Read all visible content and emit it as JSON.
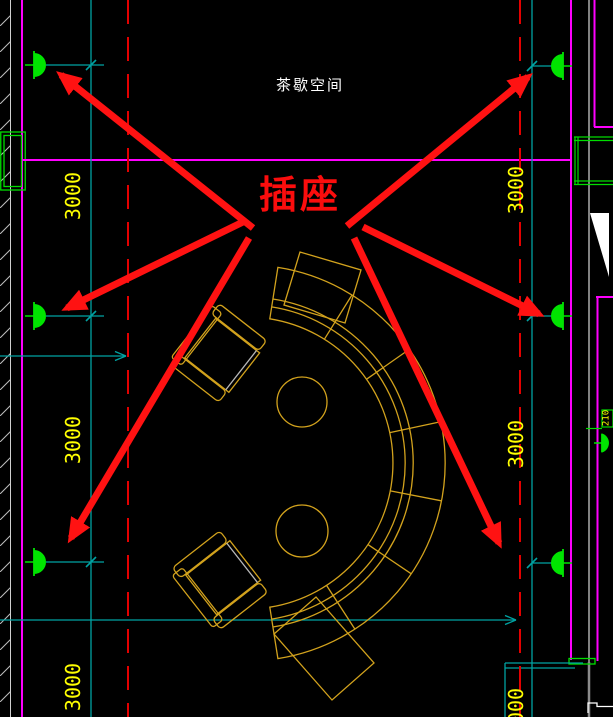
{
  "drawing_title": {
    "room_label": "茶歇空间"
  },
  "callout": {
    "label": "插座"
  },
  "dimensions": {
    "left": [
      "3000",
      "3000",
      "3000"
    ],
    "right": [
      "3000",
      "3000",
      "3000"
    ],
    "side_label": "210"
  },
  "colors": {
    "background": "#000000",
    "wall_magenta": "#ff00ff",
    "dimension_cyan": "#00a2a2",
    "dimension_text_yellow": "#ffff00",
    "socket_green": "#00e400",
    "furniture_orange": "#d2a21d",
    "annotation_red": "#ff1212",
    "centerline_red": "#e30000",
    "room_text_white": "#ffffff"
  }
}
